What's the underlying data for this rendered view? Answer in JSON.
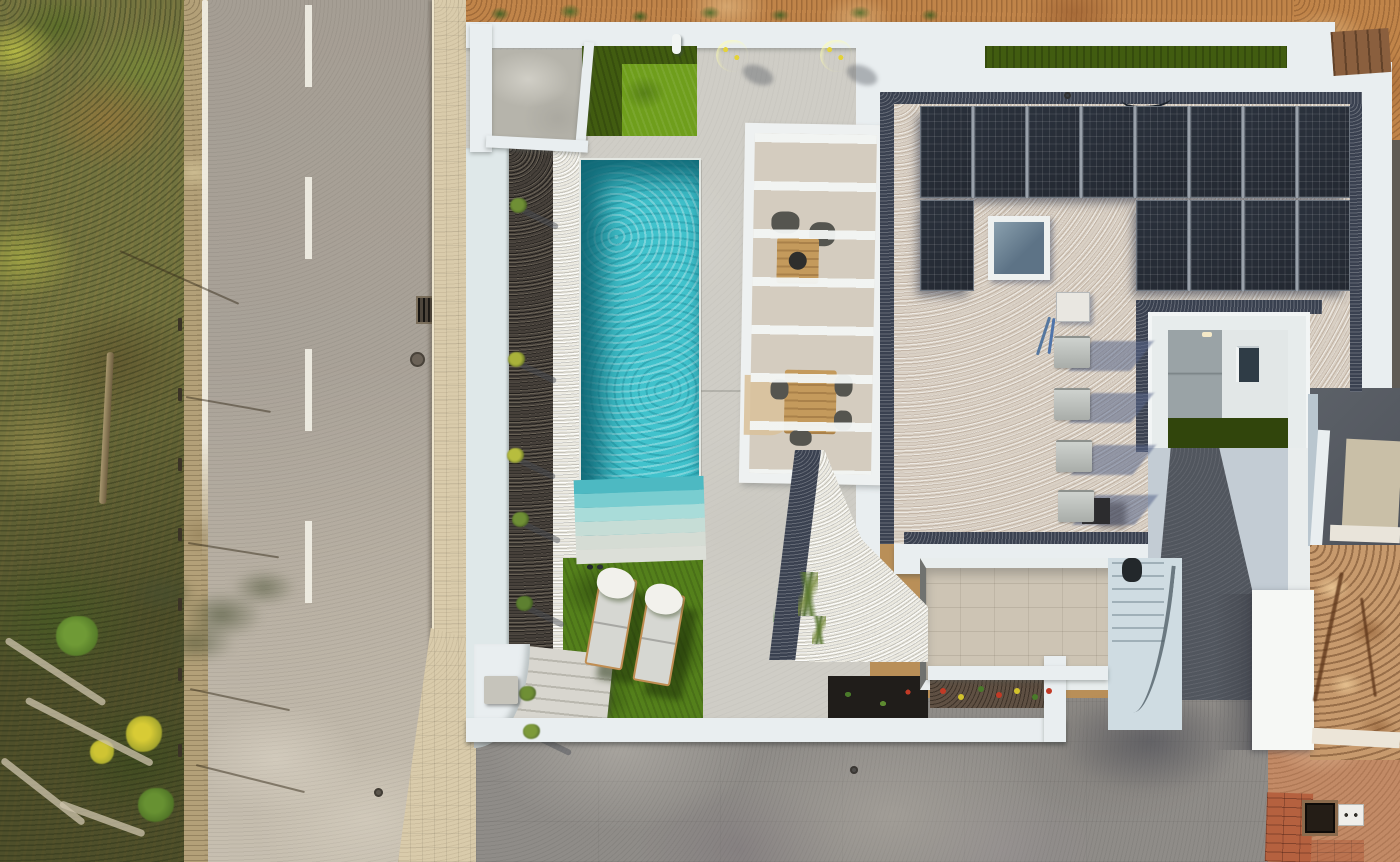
{
  "scene": {
    "type": "aerial-drone-photograph",
    "description": "Top-down aerial view of a modern white villa: turquoise pool with steps, artificial lawns, pergola lounge, flat gravel roof with solar panels and skylight, inner courtyard, entry stairs, gray concrete driveway, asphalt road with dashed centerline and tiled sidewalk on the left, scrubland verge and construction dirt lot on the right"
  },
  "objects": {
    "road": "asphalt road with white edge line and dashed centerline",
    "sidewalk": "beige tiled sidewalk",
    "verge": "scrubland with grasses, shrubs, fence posts and utility pole",
    "pool": "rectangular turquoise swimming pool with fan steps",
    "lawns": "artificial grass areas",
    "loungers_count": 2,
    "potted_plants_count": 2,
    "pergola": "white slatted pergola over lounge and dining sets",
    "solar_panels_total": 13,
    "skylight": "square roof skylight",
    "ac_units_count": 4,
    "courtyard": "inner patio with grass strip and window",
    "driveway": "large gray concrete driveway",
    "utilities": "roof electrical box, cables, dark cube, drain grate, manhole, meter box, floor hatch"
  },
  "colors": {
    "scrub_green": "#73743f",
    "sidewalk": "#d9cbab",
    "terrace": "#cfcdc6",
    "wall_white": "#e9eef0",
    "wall_blue": "#dfe8e9",
    "wall_bright": "#f6f8f5",
    "lawn_dark": "#415c10",
    "lawn_bright": "#6f9e1c",
    "lawn_mid": "#54801b",
    "pool_water": "#41c2cc",
    "pool_deep": "#17808f",
    "gravel_dark_bed": "#46403a",
    "gravel_white": "#eceae1",
    "roof_gravel": "#d9d0c4",
    "roof_gravel_dark": "#3a4150",
    "solar_panel": "#232831",
    "ac_unit": "#c3c7c3",
    "ramp": "#c3ccd4",
    "ramp_path": "#51565e",
    "patio_tile": "#cdc4b4",
    "stairs_blue": "#cfdce2",
    "driveway": "#8f8c88",
    "dirt": "#c08449",
    "brick": "#b5613f",
    "wood": "#c49a5c",
    "lounger_pad": "#d6d7d2",
    "towel": "#f2f1ec"
  },
  "layout": {
    "solar_rows": [
      {
        "x": 920,
        "y": 106,
        "w": 430,
        "h": 92,
        "panels": 8
      },
      {
        "x": 920,
        "y": 200,
        "w": 54,
        "h": 91,
        "panels": 1
      },
      {
        "x": 1136,
        "y": 200,
        "w": 214,
        "h": 91,
        "panels": 4
      }
    ],
    "ac_units": [
      {
        "x": 1054,
        "y": 336
      },
      {
        "x": 1054,
        "y": 388
      },
      {
        "x": 1056,
        "y": 440
      },
      {
        "x": 1058,
        "y": 490
      }
    ],
    "pool_steps_colors": [
      "#4db9c2",
      "#79cdd0",
      "#a9dcd9",
      "#c6ddd6",
      "#d5dcd4",
      "#dcdfd8"
    ],
    "bed_shrubs": [
      {
        "x": 510,
        "y": 198,
        "c": "#6f8f35"
      },
      {
        "x": 508,
        "y": 352,
        "c": "#a9b23a"
      },
      {
        "x": 507,
        "y": 448,
        "c": "#b7bd3e"
      },
      {
        "x": 512,
        "y": 512,
        "c": "#6f8f35"
      },
      {
        "x": 516,
        "y": 596,
        "c": "#5d8030"
      },
      {
        "x": 519,
        "y": 686,
        "c": "#6f8f35"
      },
      {
        "x": 523,
        "y": 724,
        "c": "#7d9a3a"
      }
    ],
    "loungers": [
      {
        "x": 592,
        "y": 576,
        "rot": 10
      },
      {
        "x": 640,
        "y": 592,
        "rot": 10
      }
    ],
    "potted_plants": [
      {
        "x": 716,
        "y": 40
      },
      {
        "x": 820,
        "y": 40
      }
    ],
    "flowers": [
      {
        "x": 940,
        "y": 688,
        "c": "#c23a26"
      },
      {
        "x": 958,
        "y": 694,
        "c": "#d2c22c"
      },
      {
        "x": 978,
        "y": 686,
        "c": "#4a7a2a"
      },
      {
        "x": 996,
        "y": 692,
        "c": "#c23a26"
      },
      {
        "x": 1014,
        "y": 688,
        "c": "#d2c22c"
      },
      {
        "x": 1032,
        "y": 694,
        "c": "#4a7a2a"
      },
      {
        "x": 1046,
        "y": 688,
        "c": "#c23a26"
      }
    ],
    "fence_posts_y": [
      318,
      388,
      458,
      528,
      598,
      668,
      744
    ],
    "fence_wires": [
      {
        "x": 186,
        "y": 396,
        "len": 86,
        "rot": 10
      },
      {
        "x": 188,
        "y": 542,
        "len": 92,
        "rot": 9
      },
      {
        "x": 190,
        "y": 688,
        "len": 102,
        "rot": 12
      },
      {
        "x": 196,
        "y": 764,
        "len": 112,
        "rot": 14
      },
      {
        "x": 120,
        "y": 250,
        "len": 130,
        "rot": 24
      }
    ],
    "logs": [
      {
        "x": 6,
        "y": 636,
        "len": 118,
        "rot": 33
      },
      {
        "x": 26,
        "y": 696,
        "len": 142,
        "rot": 27
      },
      {
        "x": 2,
        "y": 756,
        "len": 104,
        "rot": 38
      },
      {
        "x": 60,
        "y": 800,
        "len": 90,
        "rot": 20
      }
    ]
  }
}
